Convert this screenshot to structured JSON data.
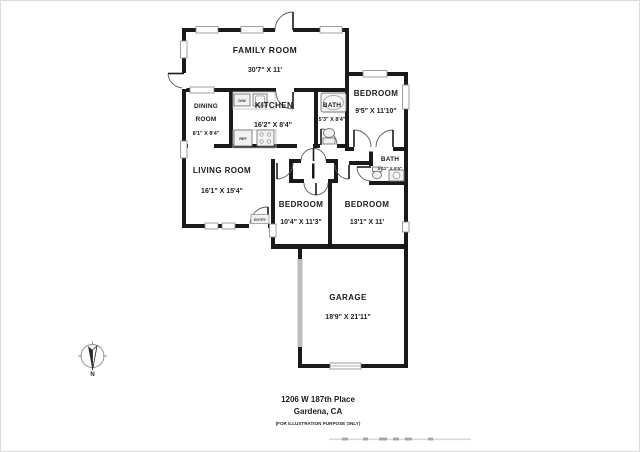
{
  "rooms": {
    "family": {
      "name": "FAMILY ROOM",
      "dims": "30'7\" X 11'"
    },
    "dining": {
      "name_line1": "DINING",
      "name_line2": "ROOM",
      "dims": "8'1\" X 8'4\""
    },
    "kitchen": {
      "name": "KITCHEN",
      "dims": "16'2\" X 8'4\""
    },
    "bath1": {
      "name": "BATH",
      "dims": "5'3\" X 8'4\""
    },
    "bedroom1": {
      "name": "BEDROOM",
      "dims": "9'5\" X 11'10\""
    },
    "living": {
      "name": "LIVING ROOM",
      "dims": "16'1\" X 15'4\""
    },
    "bath2": {
      "name": "BATH",
      "dims": "5'11\" X 5'5\""
    },
    "bedroom2": {
      "name": "BEDROOM",
      "dims": "10'4\" X 11'3\""
    },
    "bedroom3": {
      "name": "BEDROOM",
      "dims": "13'1\" X 11'"
    },
    "garage": {
      "name": "GARAGE",
      "dims": "18'9\" X 21'11\""
    }
  },
  "fixtures": {
    "dishwasher_label": "D/W",
    "refrigerator_label": "REF",
    "entry_label": "ENTRY"
  },
  "compass": {
    "north_label": "N"
  },
  "footer": {
    "address_line1": "1206 W 187th Place",
    "address_line2": "Gardena, CA",
    "disclaimer": "(FOR ILLUSTRATION PURPOSE ONLY)"
  },
  "colors": {
    "wall": "#1a1a1a",
    "background": "#ffffff",
    "window_stroke": "#8a8a8a",
    "garage_strip": "#bdbdbd"
  }
}
